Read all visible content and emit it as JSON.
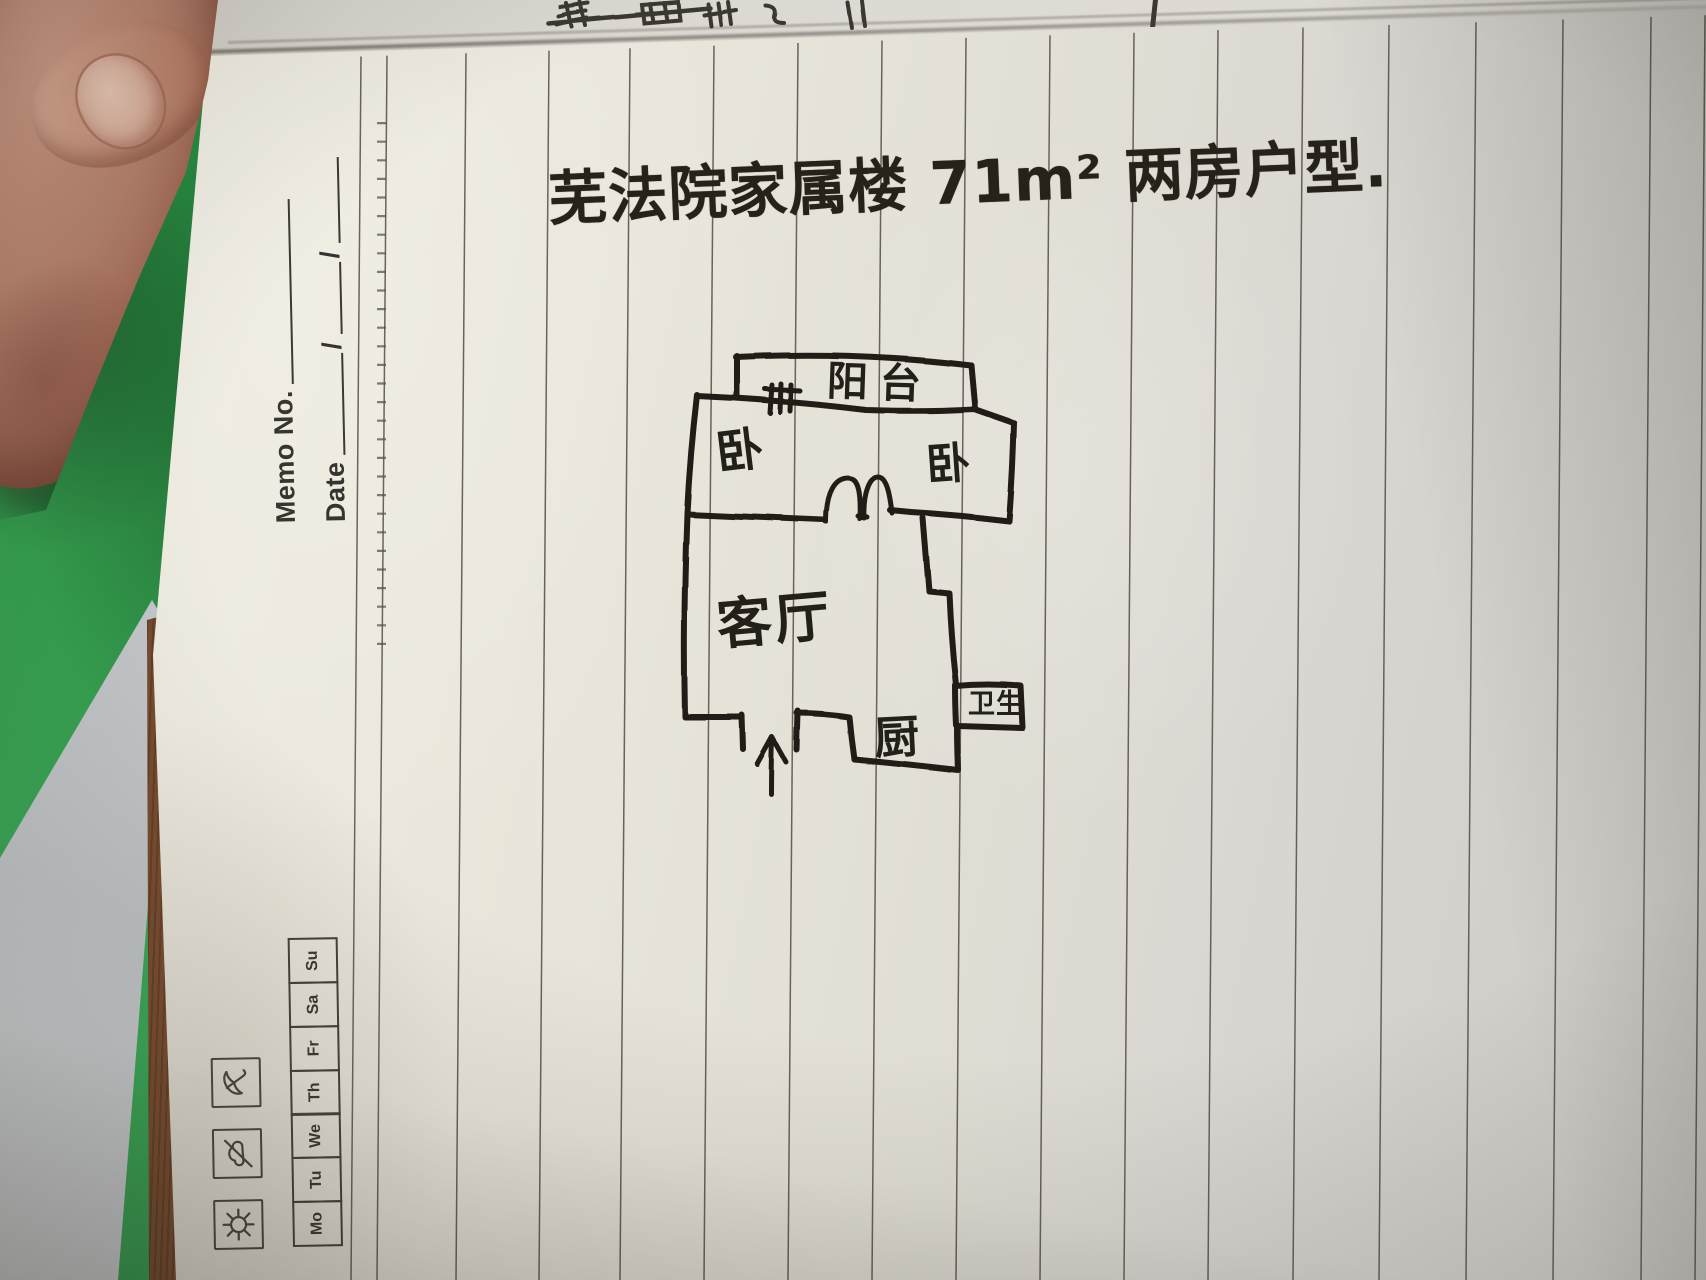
{
  "photo": {
    "handwritten_title": "芜法院家属楼 71m² 两房户型.",
    "floor_plan": {
      "balcony_label": "阳台",
      "bedroom_left_label": "卧",
      "bedroom_right_label": "卧",
      "living_room_label": "客厅",
      "kitchen_label": "厨",
      "bathroom_label": "卫生",
      "icons": {
        "entry": "entry-arrow-up-icon",
        "window": "window-hatch-icon",
        "doors": "double-door-arc-icon"
      }
    },
    "memo_header": {
      "memo_no_label": "Memo No.",
      "date_label": "Date",
      "slash": "/",
      "days": [
        "Mo",
        "Tu",
        "We",
        "Th",
        "Fr",
        "Sa",
        "Su"
      ],
      "weather_icons": [
        "sun-icon",
        "cloud-icon",
        "umbrella-icon"
      ]
    },
    "colors": {
      "green_mat": "#2e9c4a",
      "paper": "#e8e4d9",
      "ink": "#201c17",
      "rule_line": "#56514a",
      "table_surface": "#c9cbcd",
      "binding_edge": "#8a5a38"
    }
  }
}
